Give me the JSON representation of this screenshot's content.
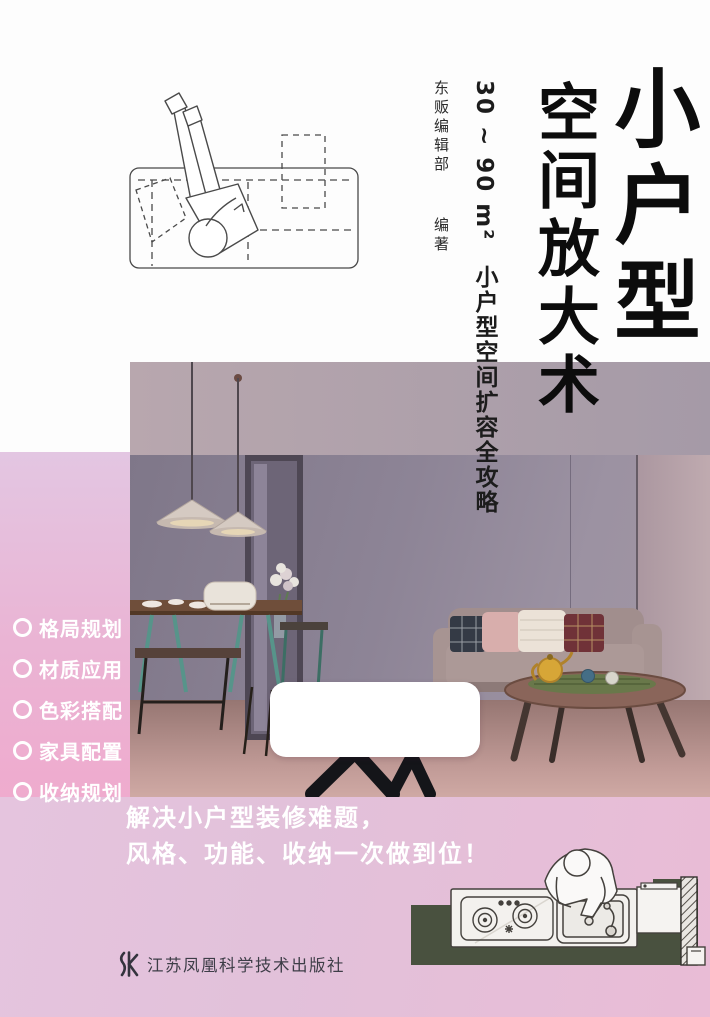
{
  "book": {
    "title_main": "小户型",
    "title_sub": "空间放大术",
    "subtitle_range": "30 ~ 90 m²",
    "subtitle_text": "小户型空间扩容全攻略",
    "author": "东贩编辑部",
    "author_role": "编著",
    "features": [
      "格局规划",
      "材质应用",
      "色彩搭配",
      "家具配置",
      "收纳规划"
    ],
    "tagline": [
      "解决小户型装修难题，",
      "风格、功能、收纳一次做到位！"
    ],
    "publisher": "江苏凤凰科学技术出版社"
  },
  "icons": {
    "sofa_topview": "line drawing of person lying on sofa (plan view)",
    "kitchen_topview": "line drawing of person at kitchen sink and stove (plan view)",
    "phoenix_logo": "Jiangsu Phoenix publisher mark",
    "circle_bullet": "white ring bullet"
  },
  "colors": {
    "pink_strip": "#eab4d4",
    "pink_band": "#e5c4de",
    "title_ink": "#0c0c0c",
    "feature_text": "#ffffff",
    "tagline_text": "#ffffff",
    "olive_counter": "#49513f",
    "publisher_ink": "#3d3d47",
    "wall": "#8d8496",
    "floor": "#c19b97"
  }
}
